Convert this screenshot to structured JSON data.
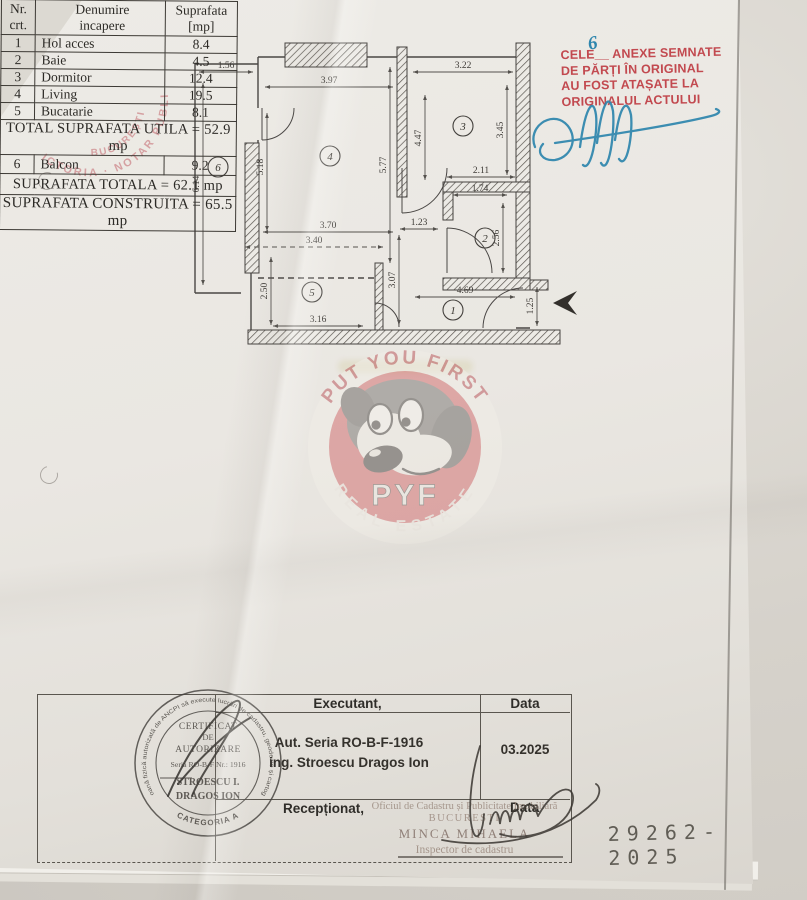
{
  "annex_note": {
    "line1": "CELE__ ANEXE SEMNATE",
    "line2": "DE PĂRȚI ÎN ORIGINAL",
    "line3": "AU FOST ATAȘATE LA",
    "line4": "ORIGINALUL ACTULUI",
    "handwritten_count": "6",
    "color": "#c2494f"
  },
  "notary_stamp": {
    "outer_arc": "VICTORIA · NOTAR PUBLIC",
    "inner_arc": "BUCUREȘTI",
    "color": "#c4666c"
  },
  "floor_plan": {
    "rooms": {
      "r1": "1",
      "r2": "2",
      "r3": "3",
      "r4": "4",
      "r5": "5",
      "r6": "6"
    },
    "dims": {
      "balcony_w": "1.56",
      "balcony_h": "6.14",
      "living_w": "3.97",
      "living_h_left": "5.18",
      "living_h_right": "5.77",
      "dormitor_w": "3.22",
      "dormitor_h": "3.45",
      "dormitor_left": "4.47",
      "bath_outer_w": "2.11",
      "bath_inner_w": "1.74",
      "bath_h": "2.56",
      "corridor_w": "1.23",
      "kitchen_top": "3.70",
      "kitchen_top_dashed": "3.40",
      "kitchen_left": "2.50",
      "kitchen_bottom": "3.16",
      "hall_left": "3.07",
      "hall_w": "4.69",
      "entrance_h": "1.25"
    }
  },
  "watermark": {
    "arc_top": "PUT YOU FIRST",
    "brand": "PYF",
    "arc_bottom": "REAL ESTATE",
    "ring_color": "#c75c60"
  },
  "area_table": {
    "header": {
      "c1a": "Nr.",
      "c1b": "crt.",
      "c2a": "Denumire",
      "c2b": "incapere",
      "c3a": "Suprafata",
      "c3b": "[mp]"
    },
    "rows": [
      {
        "nr": "1",
        "name": "Hol acces",
        "mp": "8.4"
      },
      {
        "nr": "2",
        "name": "Baie",
        "mp": "4.5"
      },
      {
        "nr": "3",
        "name": "Dormitor",
        "mp": "12.4"
      },
      {
        "nr": "4",
        "name": "Living",
        "mp": "19.5"
      },
      {
        "nr": "5",
        "name": "Bucatarie",
        "mp": "8.1"
      }
    ],
    "total_utila": "TOTAL SUPRAFATA UTILA = 52.9 mp",
    "balcon_row": {
      "nr": "6",
      "name": "Balcon",
      "mp": "9.2"
    },
    "total_totala": "SUPRAFATA TOTALA = 62.1 mp",
    "total_construita": "SUPRAFATA CONSTRUITA = 65.5 mp"
  },
  "footer": {
    "executant_label": "Executant,",
    "data_label_top": "Data",
    "executant_line1": "Aut. Seria RO-B-F-1916",
    "executant_line2": "ing. Stroescu Dragos Ion",
    "date_value": "03.2025",
    "receptionat_label": "Recepționat,",
    "data_label_bottom": "Data"
  },
  "certificate_stamp": {
    "ring_text": "Persoană fizică autorizată de ANCPI să execute lucrări de cadastru, geodezie și cartografie",
    "categoria": "CATEGORIA A",
    "l1": "CERTIFICAT",
    "l2": "DE",
    "l3": "AUTORIZARE",
    "l4": "Seria RO-B-F Nr.: 1916",
    "l5": "STROESCU I.",
    "l6": "DRAGOS ION"
  },
  "reception_stamp": {
    "office": "Oficiul de Cadastru și Publicitate Imobiliară",
    "city": "BUCUREȘTI",
    "name": "MINCA MIHAELA",
    "role": "Inspector de cadastru"
  },
  "registration_number": "29262-2025"
}
